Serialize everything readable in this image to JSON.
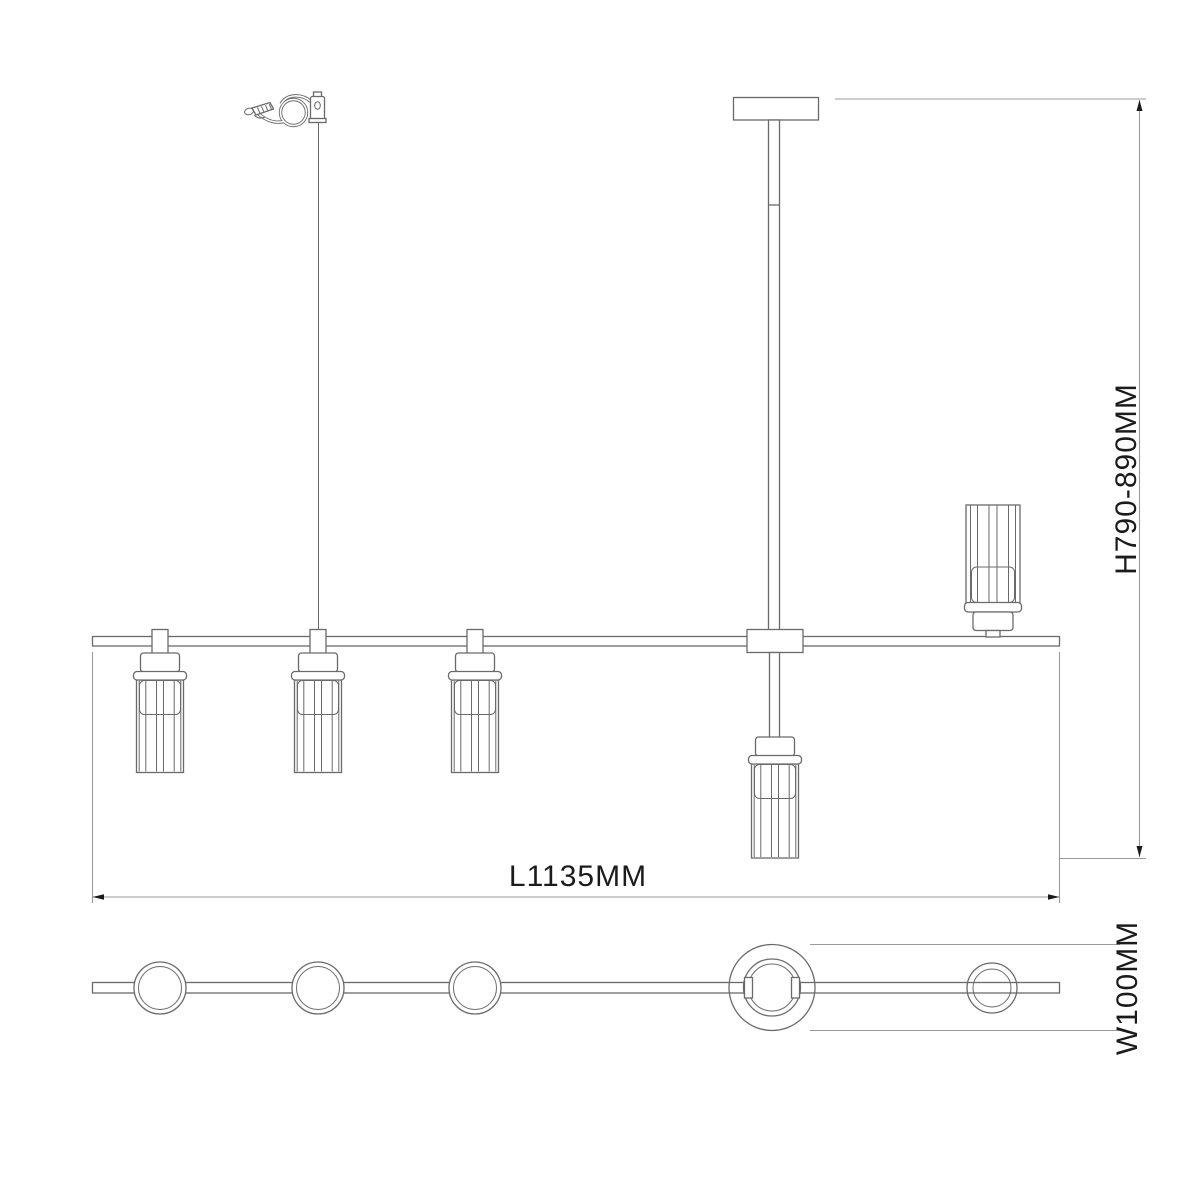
{
  "drawing": {
    "dimension_labels": {
      "length": "L1135MM",
      "height": "H790-890MM",
      "width": "W100MM"
    }
  },
  "colors": {
    "background": "#ffffff",
    "drawing_line": "#6a6a6a",
    "dimension_line": "#9a9a9a",
    "label_text": "#1b1b1b"
  }
}
